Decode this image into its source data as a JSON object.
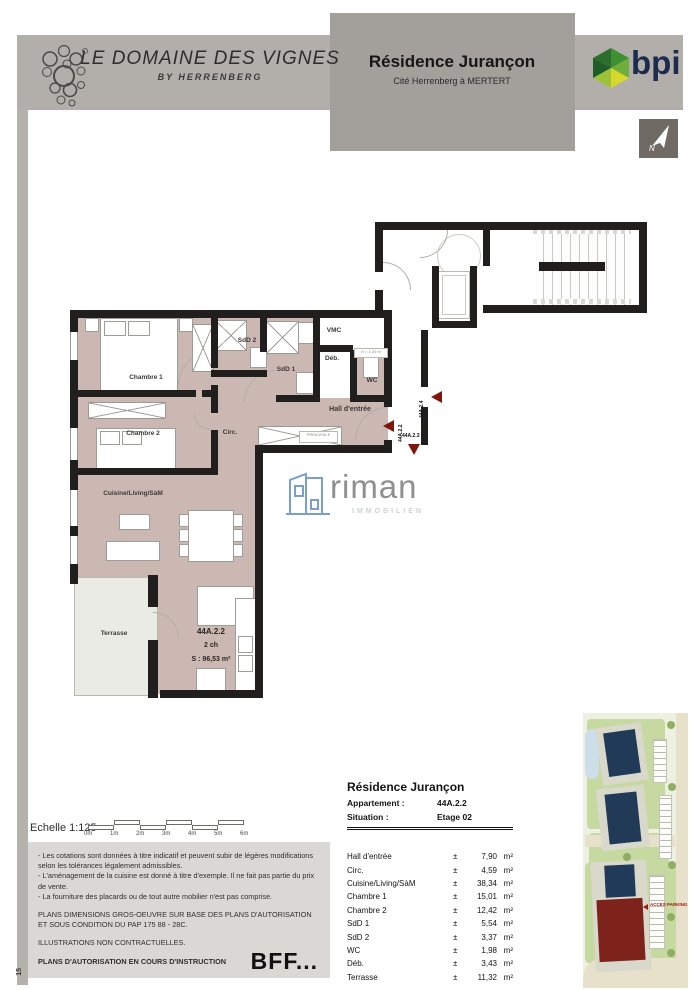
{
  "header": {
    "brand": {
      "title": "LE DOMAINE DES VIGNES",
      "subtitle": "BY HERRENBERG"
    },
    "project": {
      "title": "Résidence Jurançon",
      "subtitle": "Cité Herrenberg à MERTERT"
    },
    "bpi_logo_text": "bpi",
    "north_letter": "N"
  },
  "plan": {
    "rooms": {
      "chambre1": "Chambre 1",
      "chambre2": "Chambre 2",
      "sdd2": "SdD 2",
      "sdd1": "SdD 1",
      "vmc": "VMC",
      "deb": "Déb.",
      "wc": "WC",
      "hall": "Hall d'entrée",
      "circ": "Circ.",
      "cuisine": "Cuisine/Living/SàM",
      "terrasse": "Terrasse"
    },
    "unit": {
      "code": "44A.2.2",
      "rooms_count": "2 ch",
      "surface": "S : 96,53 m²"
    },
    "markers": {
      "m_2_4": "44A.2.4",
      "m_2_2": "44A.2.2",
      "m_2_3": "44A.2.3"
    },
    "tiny_labels": {
      "closet": "PRINCIPALE",
      "wc_height": "H = 1,20 m"
    }
  },
  "watermark": {
    "name": "riman",
    "subtitle": "IMMOBILIEN"
  },
  "scale": {
    "label": "Echelle 1:125",
    "ticks": [
      "0m",
      "1m",
      "2m",
      "3m",
      "4m",
      "5m",
      "6m"
    ]
  },
  "notes": {
    "bullets": [
      "- Les cotations sont données à titre indicatif et peuvent subir de légères modifications\n  selon les tolérances légalement admissibles.",
      "- L'aménagement de la cuisine est donné à titre d'exemple. Il ne fait pas partie du prix de vente.",
      "- La fourniture des placards ou de tout autre mobilier n'est pas comprise."
    ],
    "para1": "PLANS DIMENSIONS GROS-OEUVRE SUR BASE DES PLANS D'AUTORISATION ET SOUS CONDITION DU PAP 175 88 - 28C.",
    "para2": "ILLUSTRATIONS NON CONTRACTUELLES.",
    "para3": "PLANS D'AUTORISATION EN COURS D'INSTRUCTION",
    "stamp": "BFF...",
    "page_side_number": "15"
  },
  "table": {
    "title": "Résidence Jurançon",
    "apartment_label": "Appartement :",
    "apartment_value": "44A.2.2",
    "situation_label": "Situation :",
    "situation_value": "Etage 02",
    "rows": [
      {
        "name": "Hall d'entrée",
        "pm": "±",
        "value": "7,90",
        "unit": "m²"
      },
      {
        "name": "Circ.",
        "pm": "±",
        "value": "4,59",
        "unit": "m²"
      },
      {
        "name": "Cuisine/Living/SàM",
        "pm": "±",
        "value": "38,34",
        "unit": "m²"
      },
      {
        "name": "Chambre 1",
        "pm": "±",
        "value": "15,01",
        "unit": "m²"
      },
      {
        "name": "Chambre 2",
        "pm": "±",
        "value": "12,42",
        "unit": "m²"
      },
      {
        "name": "SdD 1",
        "pm": "±",
        "value": "5,54",
        "unit": "m²"
      },
      {
        "name": "SdD 2",
        "pm": "±",
        "value": "3,37",
        "unit": "m²"
      },
      {
        "name": "WC",
        "pm": "±",
        "value": "1,98",
        "unit": "m²"
      },
      {
        "name": "Déb.",
        "pm": "±",
        "value": "3,43",
        "unit": "m²"
      },
      {
        "name": "Terrasse",
        "pm": "±",
        "value": "11,32",
        "unit": "m²"
      }
    ]
  },
  "site_plan": {
    "access_label": "ACCÈS PARKING"
  },
  "colors": {
    "header_gray": "#b2afab",
    "room_fill": "#cbb8b2",
    "wall": "#211f1d",
    "marker_red": "#7e160c",
    "bpi_navy": "#1c2b4e",
    "riman_blue": "#7b9ed1"
  }
}
